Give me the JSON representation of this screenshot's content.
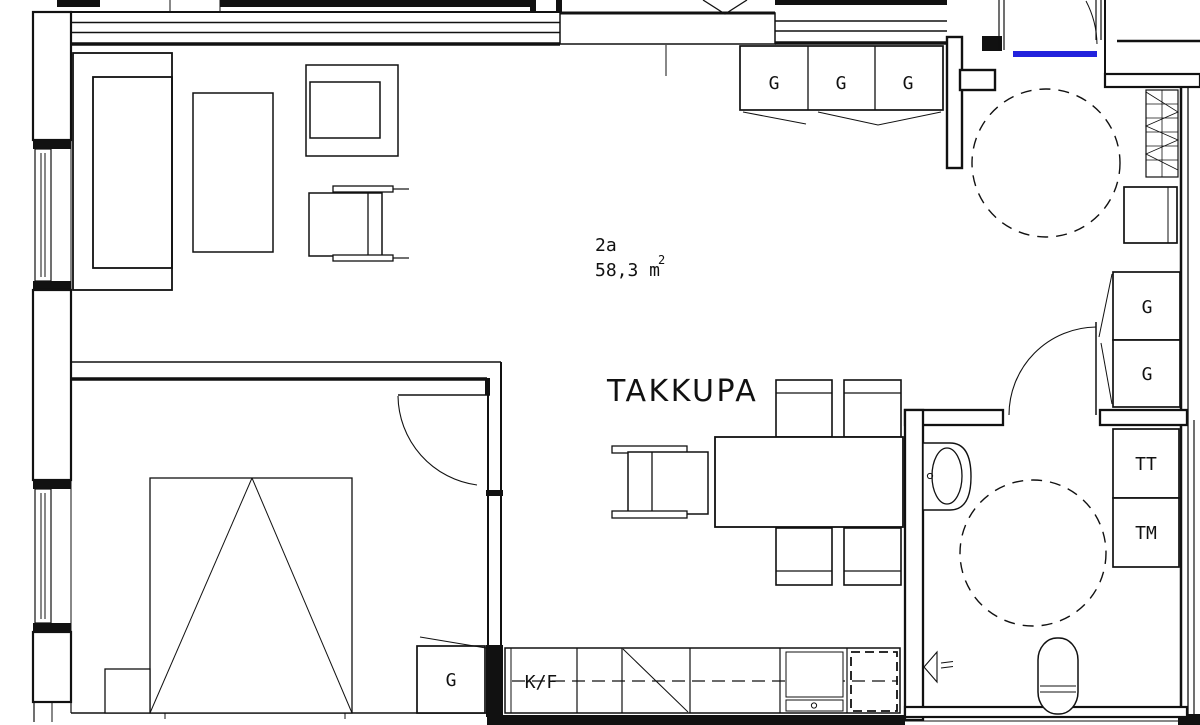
{
  "plan": {
    "unit_label": "2a",
    "area_value": "58,3 m",
    "area_sup": "2",
    "room_label": "TAKKUPA",
    "labels": {
      "wardrobe_top": [
        "G",
        "G",
        "G"
      ],
      "wardrobe_hall": [
        "G",
        "G"
      ],
      "wardrobe_bedroom": "G",
      "fridge_freezer": "K/F",
      "dryer": "TT",
      "washing_machine": "TM"
    },
    "colors": {
      "line": "#111111",
      "background": "#ffffff",
      "threshold": "#2222dd"
    }
  }
}
